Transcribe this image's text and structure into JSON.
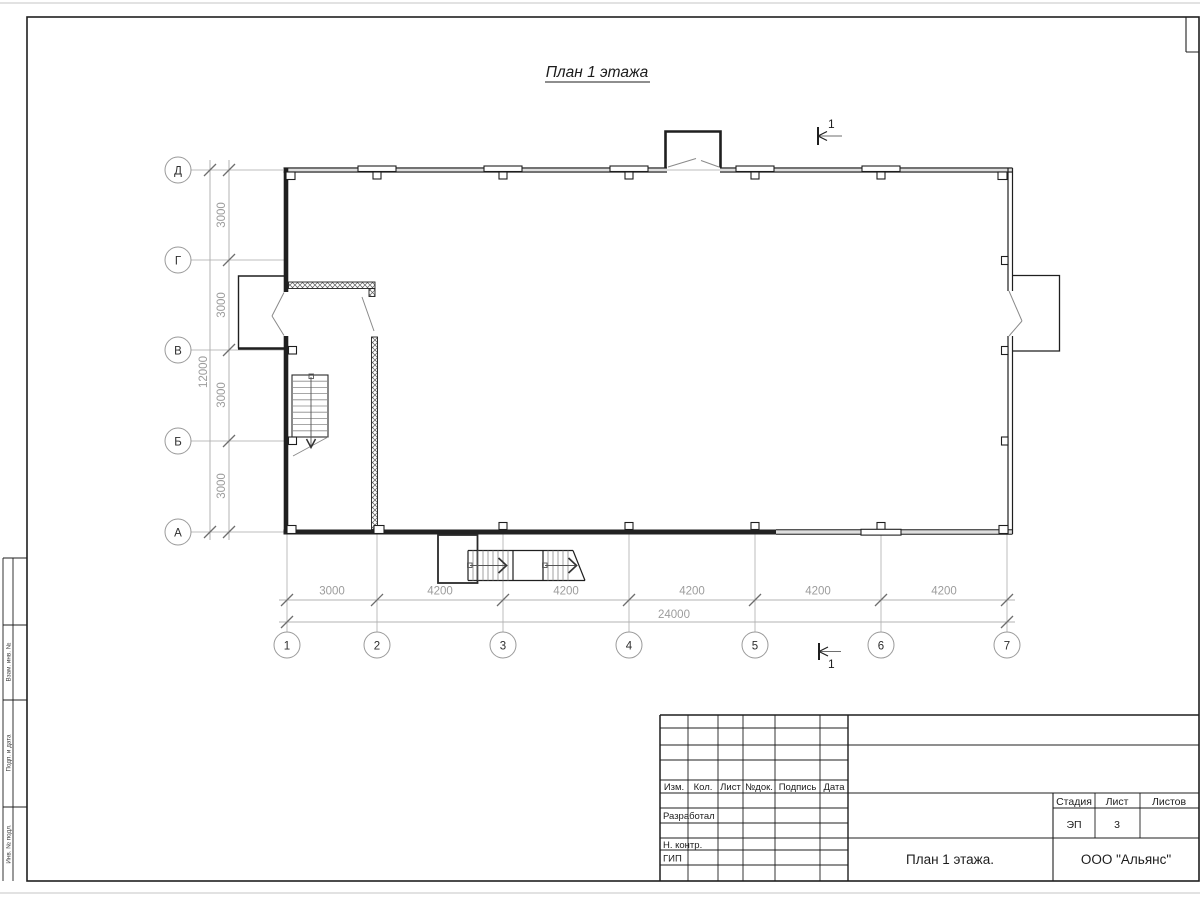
{
  "sheet_title": "План 1 этажа",
  "axes": {
    "rows": [
      "Д",
      "Г",
      "В",
      "Б",
      "А"
    ],
    "cols": [
      "1",
      "2",
      "3",
      "4",
      "5",
      "6",
      "7"
    ]
  },
  "dimensions": {
    "vertical_segments": [
      "3000",
      "3000",
      "3000",
      "3000"
    ],
    "vertical_total": "12000",
    "horizontal_segments": [
      "3000",
      "4200",
      "4200",
      "4200",
      "4200",
      "4200"
    ],
    "horizontal_total": "24000"
  },
  "section_mark": "1",
  "title_block": {
    "rev_headers": [
      "Изм.",
      "Кол.",
      "Лист",
      "№док.",
      "Подпись",
      "Дата"
    ],
    "roles": [
      "Разработал",
      "Н. контр.",
      "ГИП"
    ],
    "stage_label": "Стадия",
    "sheet_label": "Лист",
    "sheets_label": "Листов",
    "stage_value": "ЭП",
    "sheet_value": "3",
    "doc_title": "План 1 этажа.",
    "company": "ООО \"Альянс\""
  },
  "margin_labels": [
    "Взам. инв. №",
    "Подп. и дата",
    "Инв. № подл."
  ]
}
